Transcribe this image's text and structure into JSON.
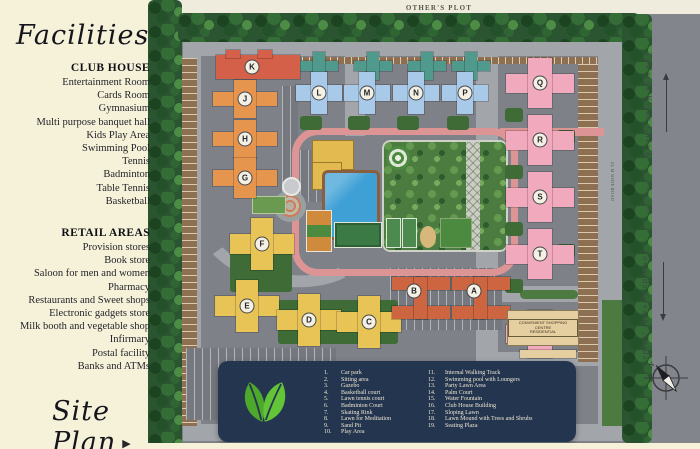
{
  "panel": {
    "title": "Facilities",
    "clubhouse": {
      "heading": "CLUB HOUSE",
      "items": [
        "Entertainment Room",
        "Cards Room",
        "Gymnasium",
        "Multi purpose banquet hall",
        "Kids Play Area",
        "Swimming Pool",
        "Tennis",
        "Badminton",
        "Table Tennis",
        "Basketball"
      ]
    },
    "retail": {
      "heading": "RETAIL AREAS",
      "items": [
        "Provision stores",
        "Book store",
        "Saloon for men and women",
        "Pharmacy",
        "Restaurants and Sweet shops",
        "Electronic gadgets store",
        "Milk booth and vegetable shop",
        "Infirmary",
        "Postal facility",
        "Banks and ATMs"
      ]
    },
    "siteplan_label": "Site Plan"
  },
  "map": {
    "others_plot": "OTHER'S PLOT",
    "towards_kisan_chowk": "Towards Kisan Chowk",
    "towards_greater_noida": "Towards Greater Noida",
    "outer_road_label": "60 M WIDE ROAD",
    "inner_road_label": "24 M WIDE ROAD",
    "compass_north": "N",
    "shopping_centre_line1": "CONVENIENT SHOPPING CENTRE",
    "shopping_centre_line2": "RESIDENTIAL",
    "towers": {
      "A": "A",
      "B": "B",
      "C": "C",
      "D": "D",
      "E": "E",
      "F": "F",
      "G": "G",
      "H": "H",
      "J": "J",
      "K": "K",
      "L": "L",
      "M": "M",
      "N": "N",
      "P": "P",
      "Q": "Q",
      "R": "R",
      "S": "S",
      "T": "T"
    }
  },
  "legend": {
    "items": [
      {
        "num": "1.",
        "label": "Car park"
      },
      {
        "num": "2.",
        "label": "Sitting area"
      },
      {
        "num": "3.",
        "label": "Gazebo"
      },
      {
        "num": "4.",
        "label": "Basketball court"
      },
      {
        "num": "5.",
        "label": "Lawn tennis court"
      },
      {
        "num": "6.",
        "label": "Badminton Court"
      },
      {
        "num": "7.",
        "label": "Skating Rink"
      },
      {
        "num": "8.",
        "label": "Lawn for Meditation"
      },
      {
        "num": "9.",
        "label": "Sand Pit"
      },
      {
        "num": "10.",
        "label": "Play Area"
      },
      {
        "num": "11.",
        "label": "Internal Walking Track"
      },
      {
        "num": "12.",
        "label": "Swimming pool with Loungers"
      },
      {
        "num": "13.",
        "label": "Party Lawn Area"
      },
      {
        "num": "14.",
        "label": "Palm Court"
      },
      {
        "num": "15.",
        "label": "Water Fountain"
      },
      {
        "num": "16.",
        "label": "Club House Building"
      },
      {
        "num": "17.",
        "label": "Sloping Lawn"
      },
      {
        "num": "18.",
        "label": "Lawn Mound with Trees and Shrubs"
      },
      {
        "num": "19.",
        "label": "Seating Plaza"
      }
    ]
  },
  "palette": {
    "cream": "#f6f2da",
    "legend": "#24364f",
    "leaf": "#5cb636",
    "pink": "#f0a9bd",
    "blue": "#a9c9e8",
    "teal": "#4f9a8c",
    "orange": "#e6954f",
    "yellow": "#e7c455",
    "red": "#d4604a",
    "rust": "#cd6540",
    "park": "#4c7c40",
    "pool": "#3fa0d6",
    "track": "#dd9494",
    "road": "#a2a6ab",
    "site": "#7e8188",
    "tan": "#e5cfa0"
  }
}
